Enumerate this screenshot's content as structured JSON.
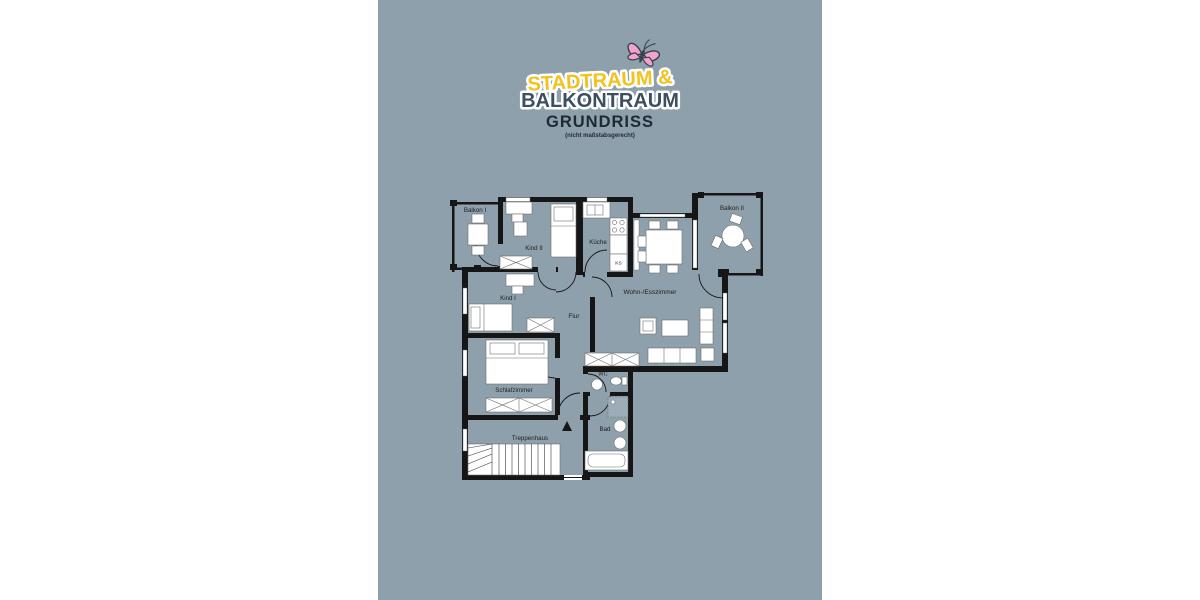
{
  "panel": {
    "background_color": "#8EA0AC"
  },
  "branding": {
    "logo_line1": "STADTRAUM &",
    "logo_line1_color": "#F3C21C",
    "logo_line2": "BALKONTRAUM",
    "logo_line2_color": "#3E4E61",
    "outline_color": "#FFFFFF",
    "butterfly_wing_color": "#F2A3CB",
    "butterfly_body_color": "#37424F",
    "title": "GRUNDRISS",
    "subtitle": "(nicht maßstabsgerecht)",
    "text_color": "#1F2933"
  },
  "floorplan": {
    "wall_color": "#161616",
    "labels": {
      "balkon1": "Balkon I",
      "kind2": "Kind II",
      "kueche": "Küche",
      "ks": "KS",
      "wohn_esszimmer": "Wohn-/Esszimmer",
      "balkon2": "Balkon II",
      "kind1": "Kind I",
      "flur": "Flur",
      "schlafzimmer": "Schlafzimmer",
      "wc": "WC",
      "bad": "Bad",
      "treppenhaus": "Treppenhaus"
    }
  }
}
